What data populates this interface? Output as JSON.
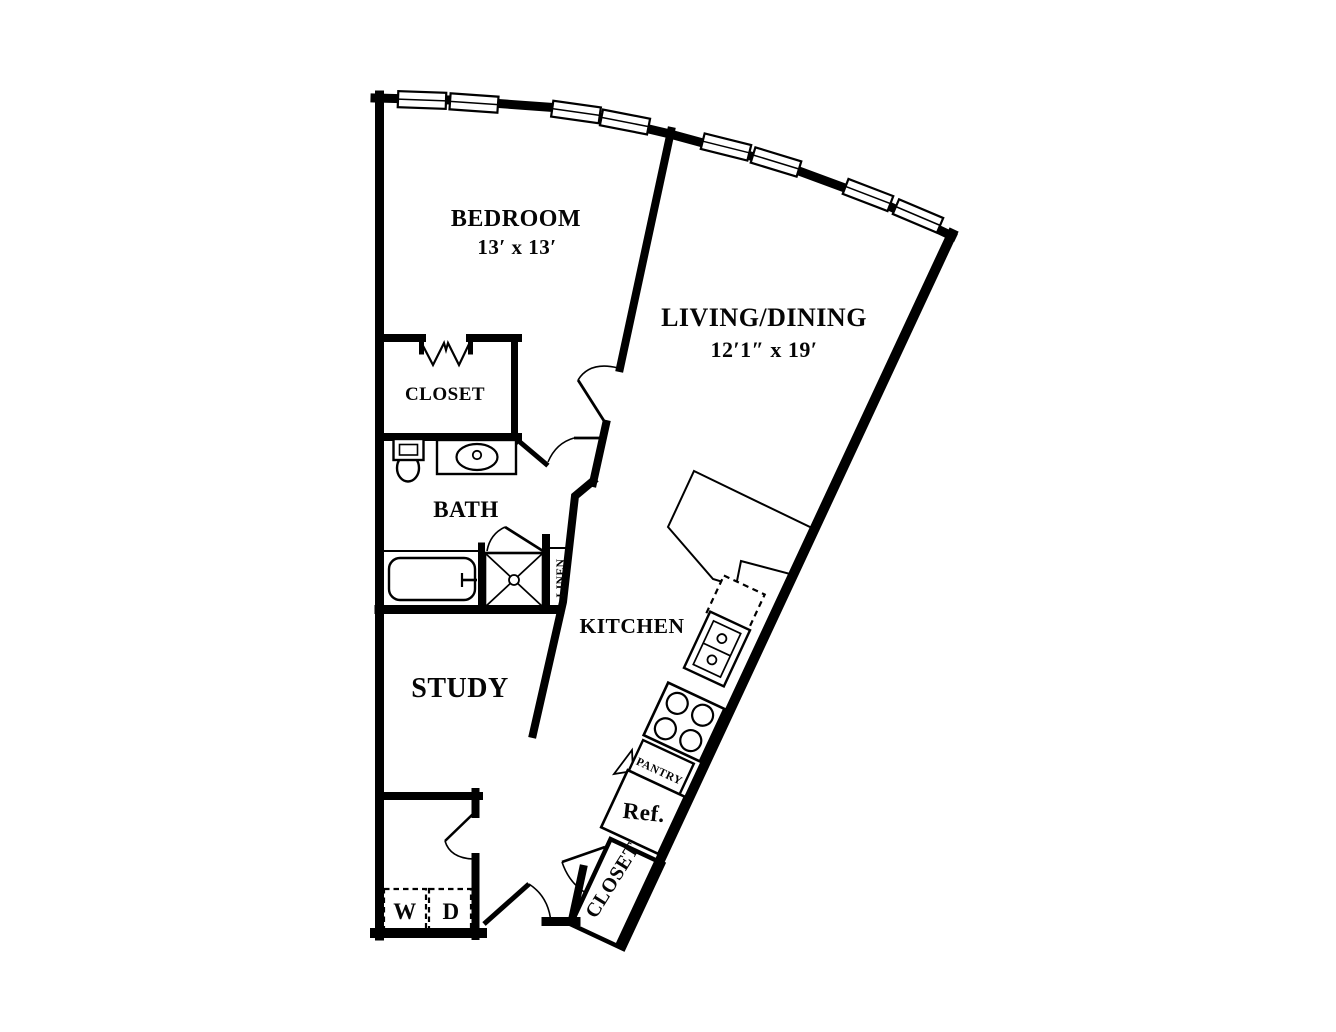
{
  "rooms": {
    "bedroom": {
      "label": "BEDROOM",
      "dimensions": "13′ x 13′"
    },
    "living_dining": {
      "label": "LIVING/DINING",
      "dimensions": "12′1″ x 19′"
    },
    "bedroom_closet": {
      "label": "CLOSET"
    },
    "bath": {
      "label": "BATH"
    },
    "linen": {
      "label": "LINEN"
    },
    "kitchen": {
      "label": "KITCHEN"
    },
    "study": {
      "label": "STUDY"
    },
    "pantry": {
      "label": "PANTRY"
    },
    "entry_closet": {
      "label": "CLOSET"
    }
  },
  "appliances": {
    "refrigerator": {
      "label": "Ref."
    },
    "washer": {
      "label": "W"
    },
    "dryer": {
      "label": "D"
    }
  },
  "colors": {
    "line": "#000000",
    "background": "#ffffff"
  }
}
